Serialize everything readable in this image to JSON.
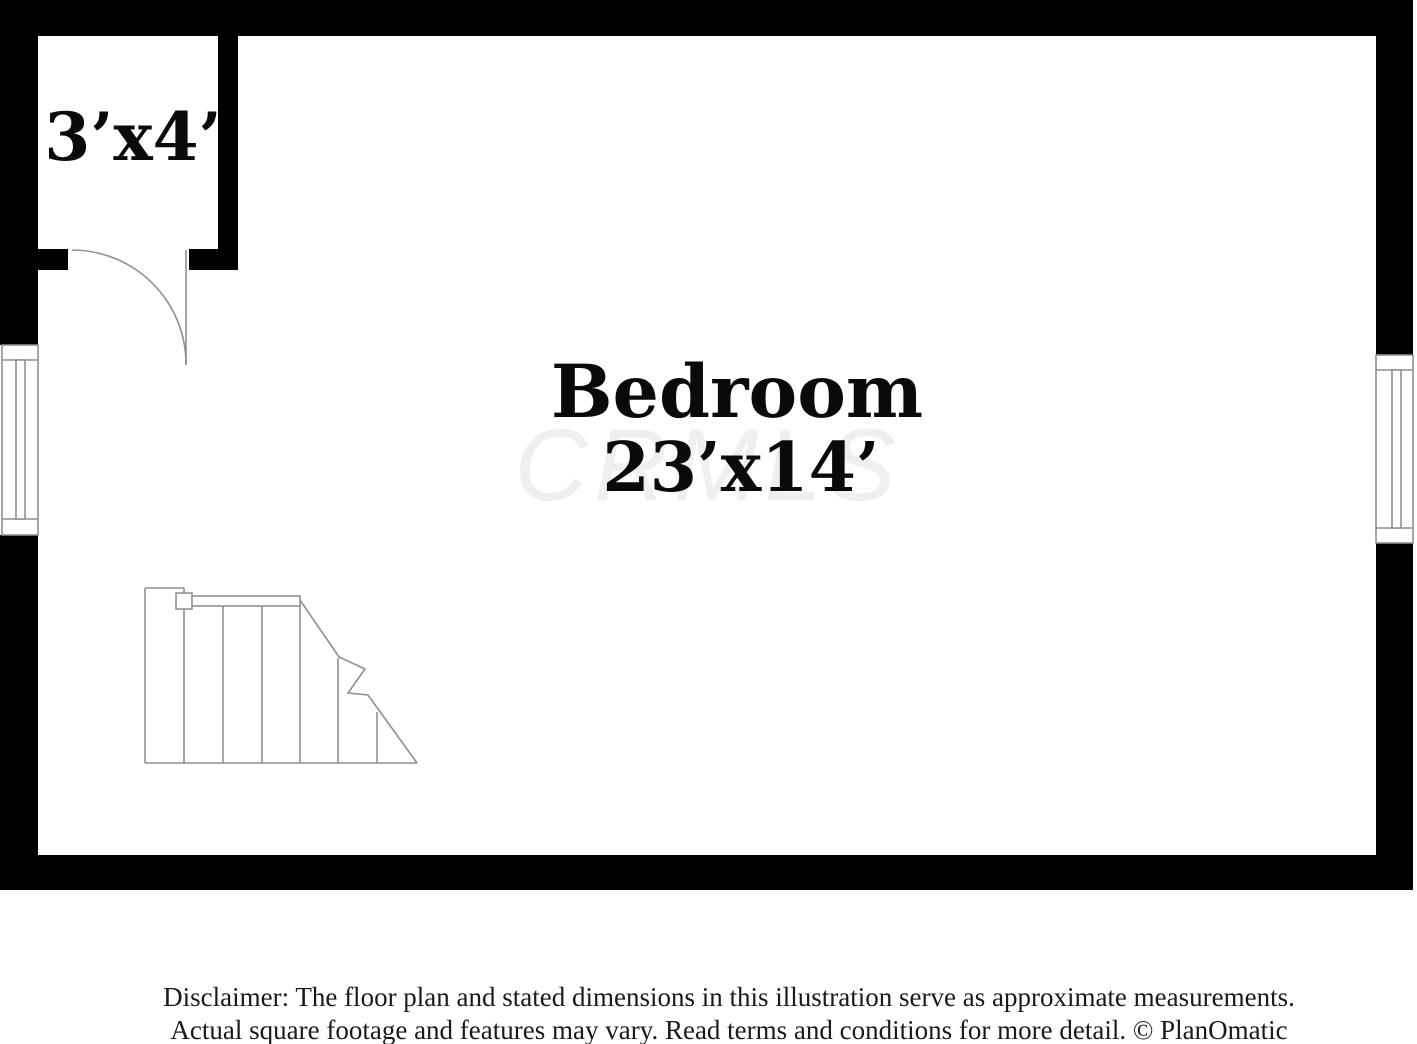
{
  "plan": {
    "closet_dimensions": "3’x4’",
    "room_name": "Bedroom",
    "room_dimensions": "23’x14’",
    "watermark": "CRMLS"
  },
  "disclaimer": {
    "line1": "Disclaimer: The floor plan and stated dimensions in this illustration serve as approximate measurements.",
    "line2": "Actual square footage and features may vary. Read terms and conditions for more detail. © PlanOmatic"
  },
  "colors": {
    "wall": "#000000",
    "symbol_line": "#8f8f8f",
    "label_text": "#0a0a0a",
    "watermark": "#efefef",
    "disclaimer_text": "#1a1a1a",
    "background": "#ffffff"
  }
}
